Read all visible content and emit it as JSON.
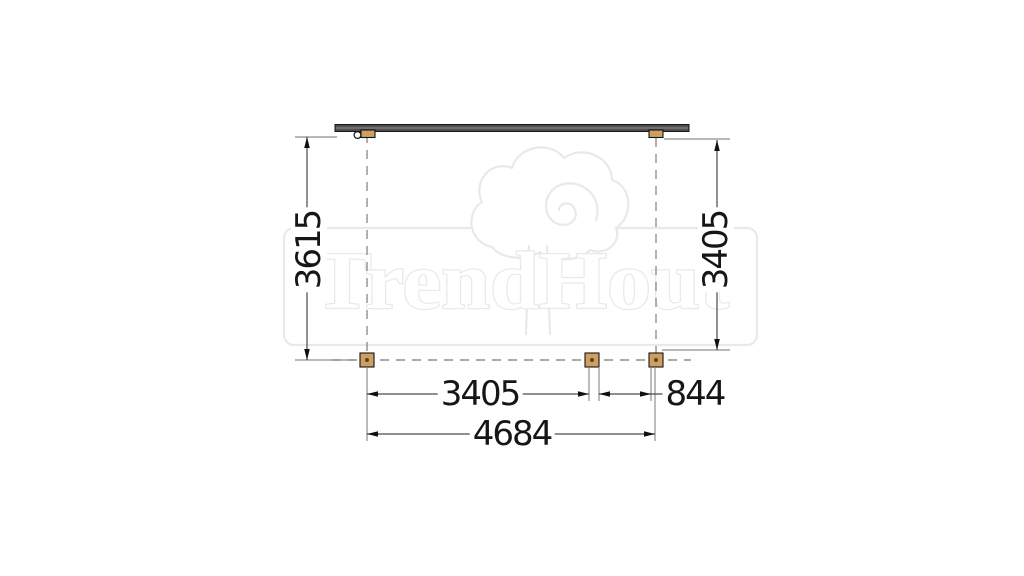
{
  "drawing": {
    "watermark": {
      "brand": "TrendHout"
    },
    "dimensions": {
      "depth_left": "3615",
      "depth_right": "3405",
      "span_field": "3405",
      "span_overhang": "844",
      "span_total": "4684"
    },
    "colors": {
      "wood": "#cd9f63",
      "wood_dot": "#5f4120",
      "beam": "#4f4f4f",
      "beam_edge": "#161616",
      "dim_line": "#4a4a4a",
      "ext_line": "#8e8e8e",
      "arrow": "#111111",
      "label_text": "#161616",
      "watermark_gray": "#e9e9e9"
    }
  }
}
